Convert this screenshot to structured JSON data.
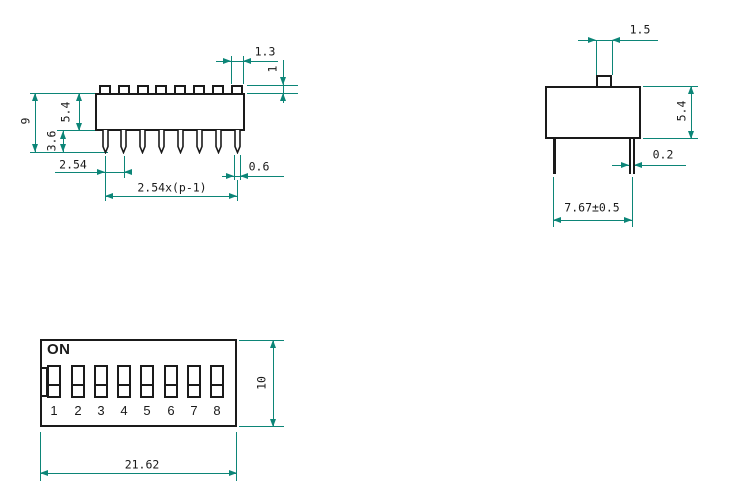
{
  "colors": {
    "ink": "#1a1a1a",
    "dimension": "#0c8577",
    "background": "#ffffff"
  },
  "front_view": {
    "dims": {
      "actuator_width": "1.3",
      "actuator_height": "1",
      "body_height": "5.4",
      "total_height": "9",
      "pin_length": "3.6",
      "pin_pitch": "2.54",
      "pin_width": "0.6",
      "pin_span": "2.54x(p-1)"
    }
  },
  "side_view": {
    "dims": {
      "actuator_width": "1.5",
      "body_height": "5.4",
      "pin_thickness": "0.2",
      "pin_row_spacing": "7.67±0.5"
    }
  },
  "top_view": {
    "on_label": "ON",
    "switch_numbers": [
      "1",
      "2",
      "3",
      "4",
      "5",
      "6",
      "7",
      "8"
    ],
    "dims": {
      "body_height": "10",
      "body_width": "21.62"
    }
  }
}
